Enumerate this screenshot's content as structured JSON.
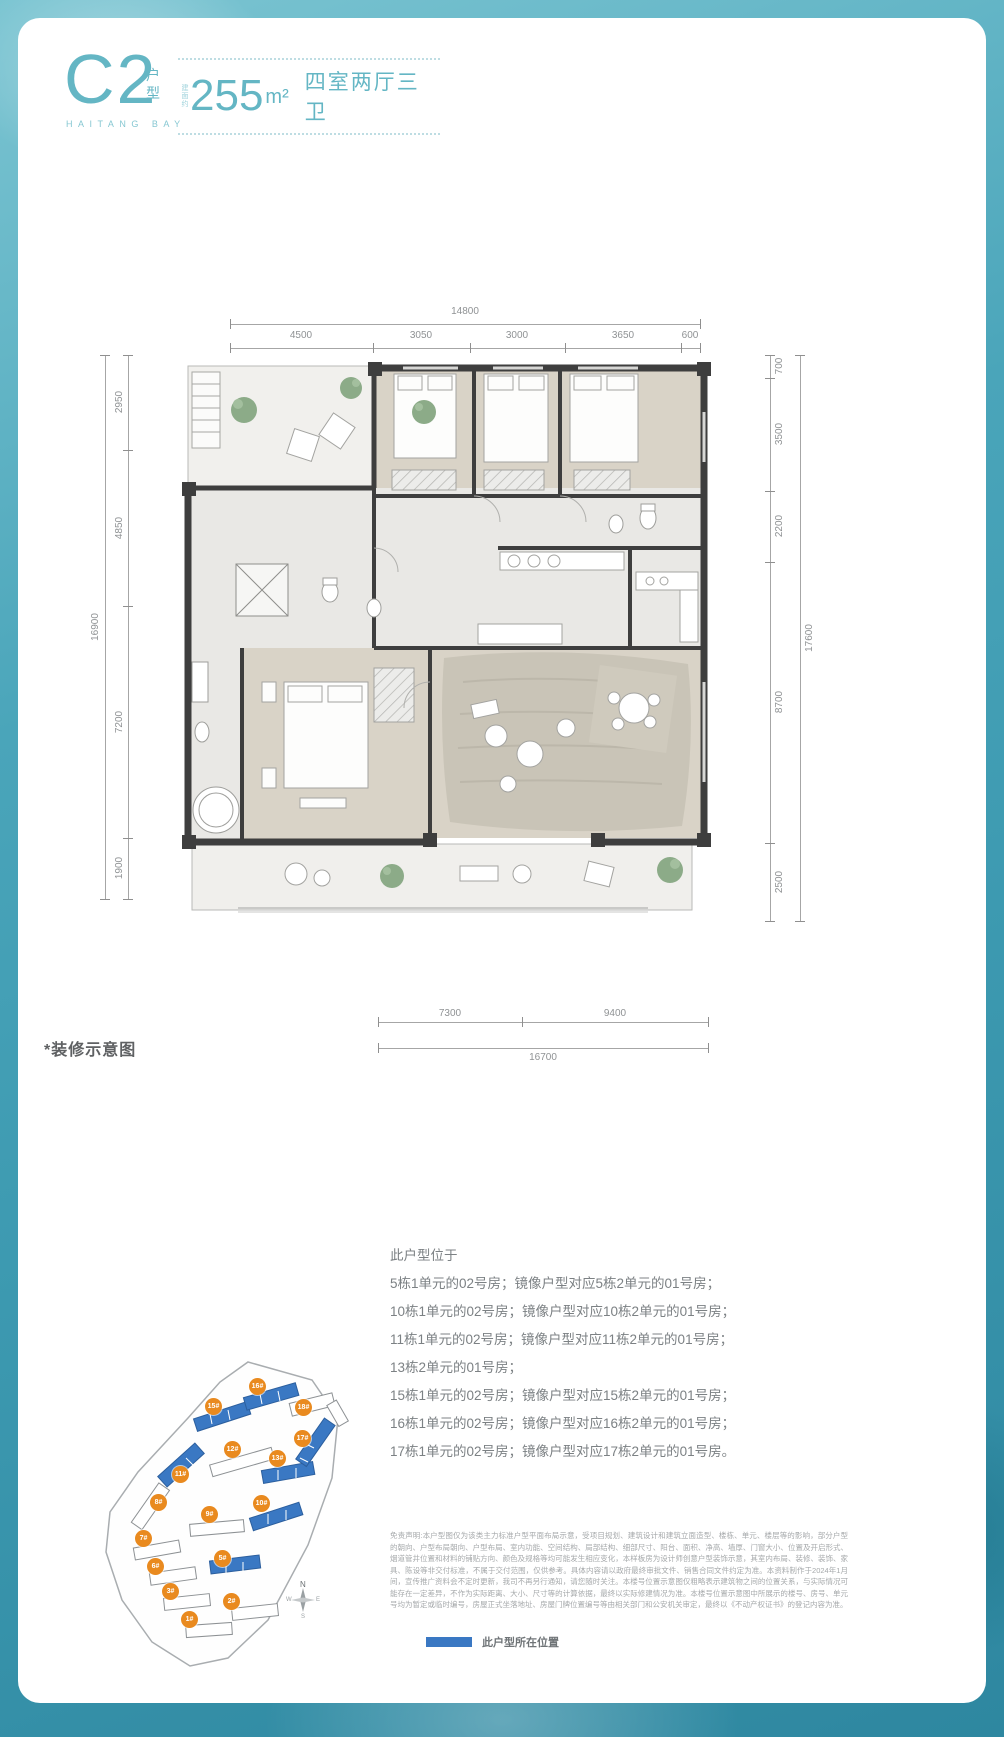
{
  "header": {
    "plan_code": "C2",
    "plan_type": "户型",
    "brand": "HAITANG BAY",
    "area_prefix": "建面约",
    "area_value": "255",
    "area_unit": "m²",
    "layout_label": "四室两厅三卫"
  },
  "colors": {
    "accent_teal": "#64b6c4",
    "badge_orange": "#e98a1f",
    "highlight_blue": "#3a78c3"
  },
  "floor_plan": {
    "note": "*装修示意图",
    "dims_top": {
      "total": "14800",
      "segments": [
        "4500",
        "3050",
        "3000",
        "3650",
        "600"
      ]
    },
    "dims_left": {
      "total": "16900",
      "segments": [
        "2950",
        "4850",
        "7200",
        "1900"
      ]
    },
    "dims_right": {
      "total": "17600",
      "segments": [
        "700",
        "3500",
        "2200",
        "8700",
        "2500"
      ]
    },
    "dims_bottom": {
      "total": "16700",
      "segments": [
        "7300",
        "9400"
      ]
    }
  },
  "location": {
    "intro": "此户型位于",
    "lines": [
      "5栋1单元的02号房；镜像户型对应5栋2单元的01号房；",
      "10栋1单元的02号房；镜像户型对应10栋2单元的01号房；",
      "11栋1单元的02号房；镜像户型对应11栋2单元的01号房；",
      "13栋2单元的01号房；",
      "15栋1单元的02号房；镜像户型对应15栋2单元的01号房；",
      "16栋1单元的02号房；镜像户型对应16栋2单元的01号房；",
      "17栋1单元的02号房；镜像户型对应17栋2单元的01号房。"
    ]
  },
  "site_map": {
    "buildings": [
      {
        "label": "1#",
        "highlight": false
      },
      {
        "label": "2#",
        "highlight": false
      },
      {
        "label": "3#",
        "highlight": false
      },
      {
        "label": "5#",
        "highlight": true
      },
      {
        "label": "6#",
        "highlight": false
      },
      {
        "label": "7#",
        "highlight": false
      },
      {
        "label": "8#",
        "highlight": false
      },
      {
        "label": "9#",
        "highlight": false
      },
      {
        "label": "10#",
        "highlight": true
      },
      {
        "label": "11#",
        "highlight": true
      },
      {
        "label": "12#",
        "highlight": false
      },
      {
        "label": "13#",
        "highlight": true
      },
      {
        "label": "15#",
        "highlight": true
      },
      {
        "label": "16#",
        "highlight": true
      },
      {
        "label": "17#",
        "highlight": true
      },
      {
        "label": "18#",
        "highlight": false
      }
    ],
    "compass": {
      "n": "N",
      "e": "E",
      "s": "S",
      "w": "W"
    }
  },
  "disclaimer": "免责声明:本户型图仅为该类主力标准户型平面布局示意，受项目规划、建筑设计和建筑立面造型、楼栋、单元、楼层等的影响，部分户型的朝向、户型布局朝向、户型布局、室内功能、空间结构、局部结构、细部尺寸、阳台、面积、净高、墙厚、门窗大小、位置及开启形式、烟道管井位置和材料的铺贴方向、颜色及规格等均可能发生相应变化，本样板房为设计师创意户型装饰示意，其室内布局、装修、装饰、家具、陈设等非交付标准，不属于交付范围，仅供参考。具体内容请以政府最终审批文件、销售合同文件约定为准。本资料制作于2024年1月间，宣传推广资料会不定时更新，我司不再另行通知，请您随时关注。本楼号位置示意图仅粗略表示建筑物之间的位置关系，与实际情况可能存在一定差异，不作为实际距离、大小、尺寸等的计算依据，最终以实际修建情况为准。本楼号位置示意图中所展示的楼号、房号、单元号均为暂定或临时编号，房屋正式坐落地址、房屋门牌位置编号等由相关部门和公安机关审定，最终以《不动产权证书》的登记内容为准。",
  "legend": {
    "label": "此户型所在位置"
  }
}
